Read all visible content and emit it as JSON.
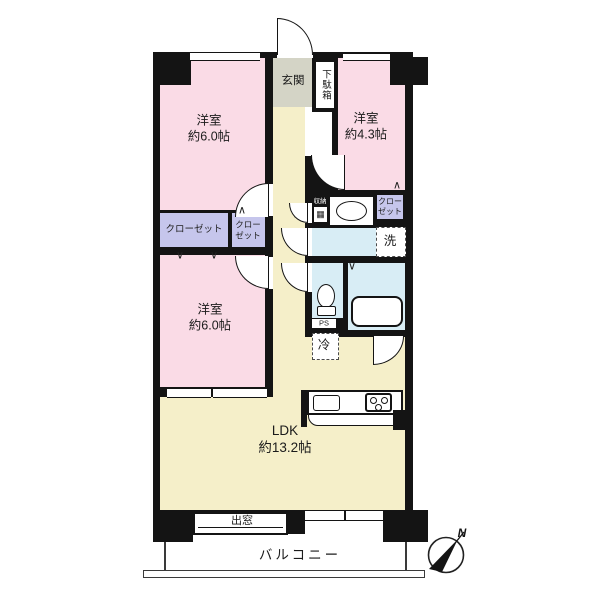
{
  "floor_plan": {
    "rooms": {
      "bedroom_nw": {
        "name": "洋室",
        "size": "約6.0帖"
      },
      "bedroom_ne": {
        "name": "洋室",
        "size": "約4.3帖"
      },
      "bedroom_w": {
        "name": "洋室",
        "size": "約6.0帖"
      },
      "ldk": {
        "name": "LDK",
        "size": "約13.2帖"
      },
      "entrance": "玄関",
      "shoe_cabinet": "下駄箱",
      "closet_large": "クローゼット",
      "closet_small": {
        "line1": "クロー",
        "line2": "ゼット"
      },
      "closet_ne": {
        "line1": "クロー",
        "line2": "ゼット"
      },
      "storage": "収納",
      "washer": "洗",
      "fridge": "冷",
      "pipe_space": "PS",
      "bay_window": "出窓",
      "balcony": "バルコニー"
    },
    "compass": {
      "north": "N"
    },
    "icons": {
      "folding_door_up": "∧",
      "folding_door_down": "∨",
      "storage_glyph": "▦"
    },
    "colors": {
      "wall": "#141414",
      "bedroom": "#fadbe6",
      "living": "#f5efc9",
      "closet": "#c6c6ec",
      "entrance_floor": "#d4d4c6",
      "wet_area": "#d8edf5"
    }
  }
}
